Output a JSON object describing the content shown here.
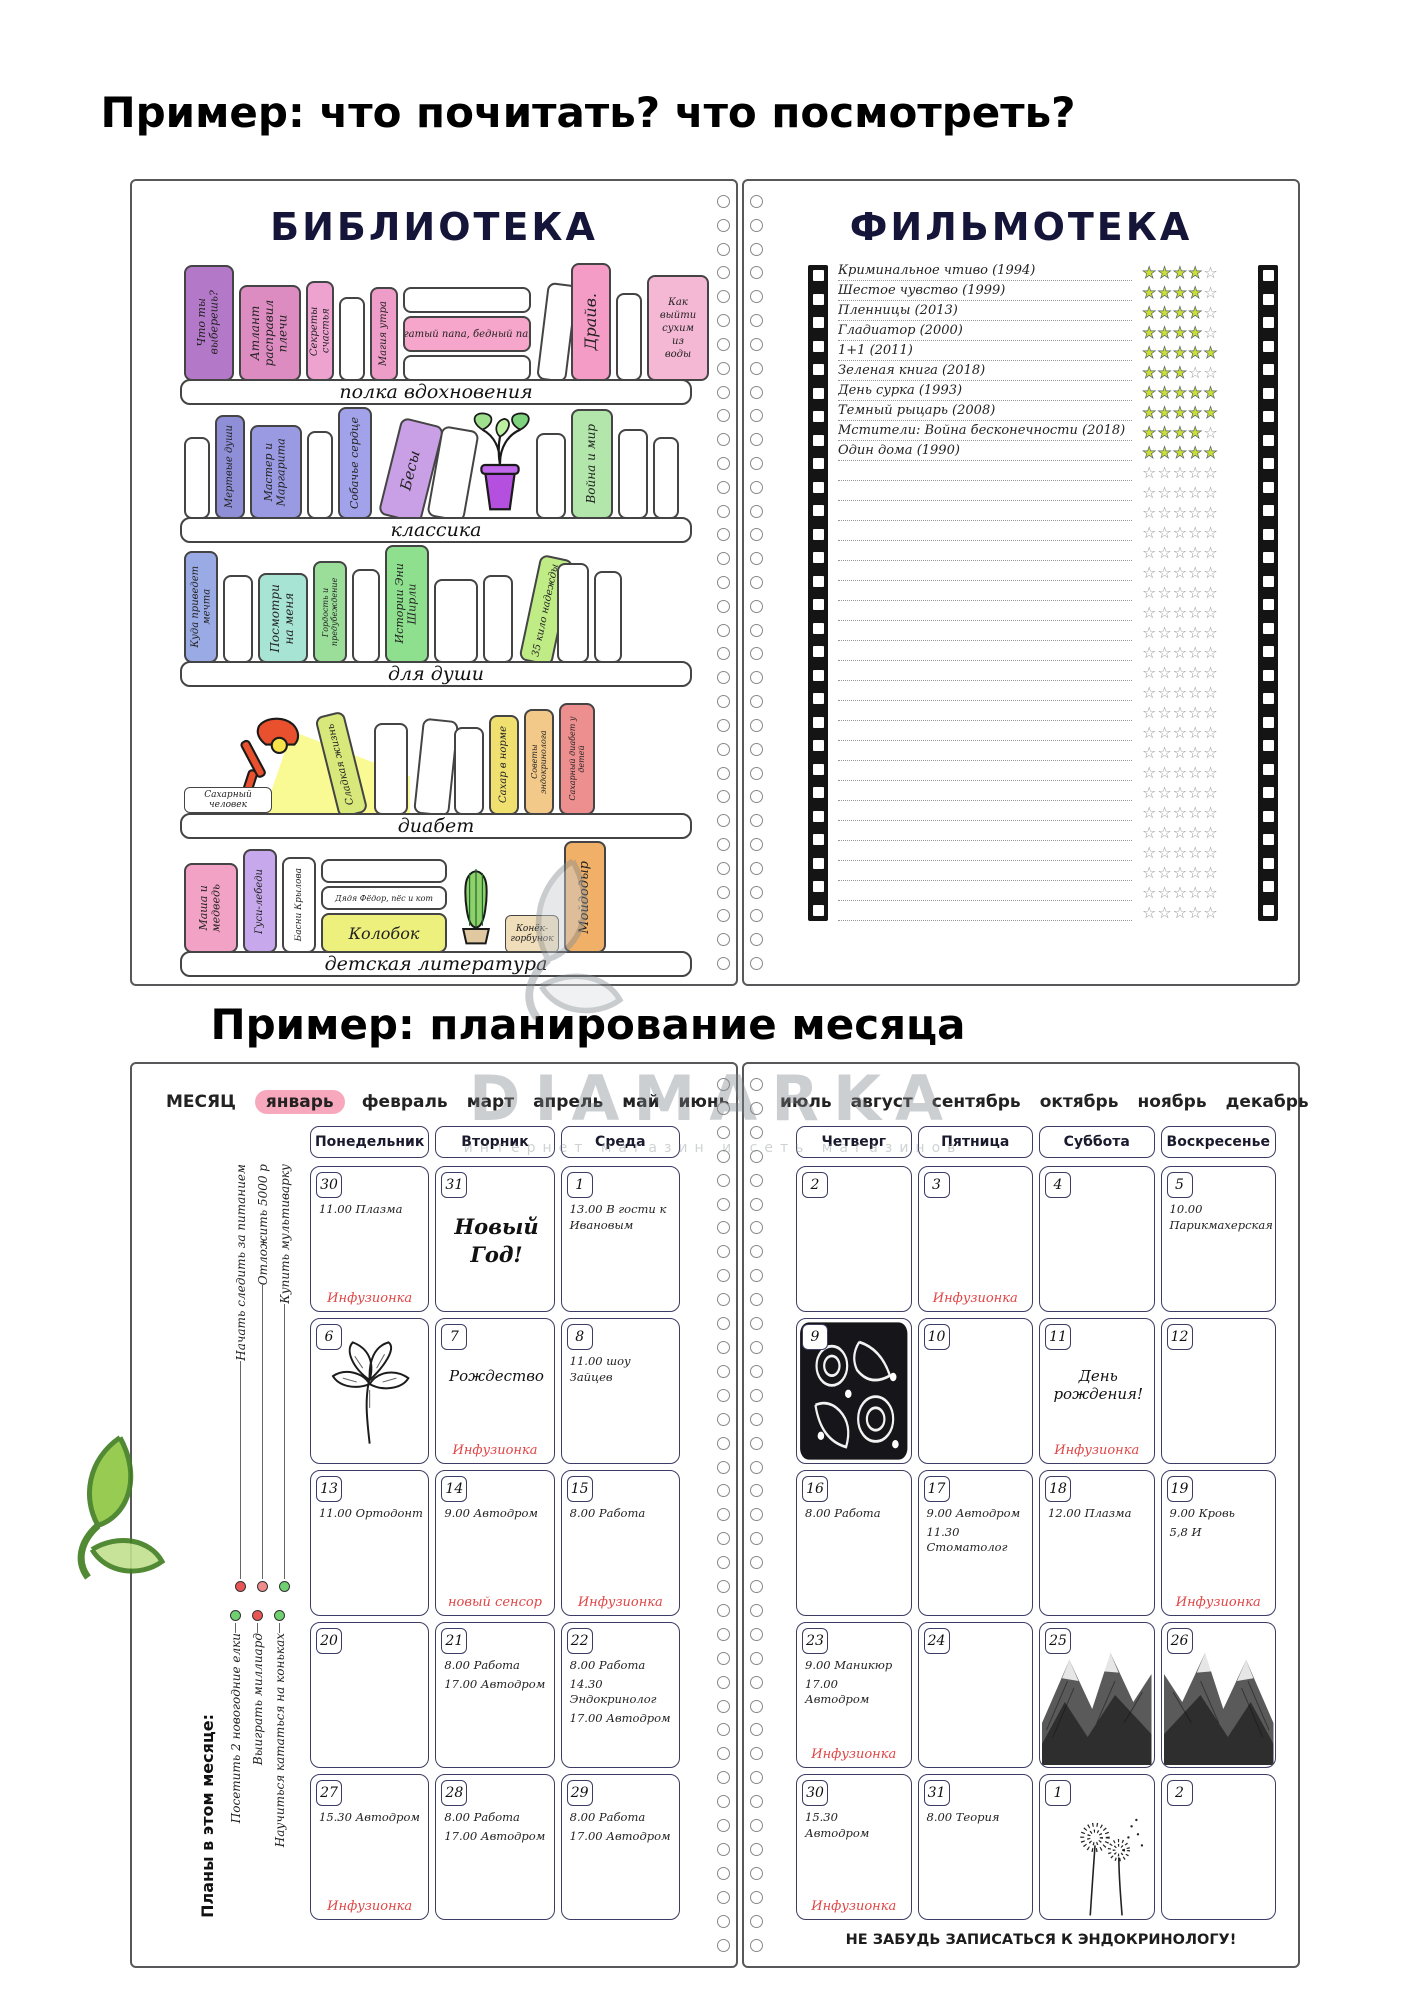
{
  "page": {
    "title_reading": "Пример: что почитать? что посмотреть?",
    "title_planning": "Пример: планирование месяца"
  },
  "watermark": {
    "brand": "DIAMARKA",
    "subtitle": "интернет магазин и сеть магазинов"
  },
  "colors": {
    "accent_red": "#e04545",
    "star_fill": "#ccdf35",
    "star_empty": "#999999",
    "month_highlight": "#f8a8bc"
  },
  "library": {
    "title": "БИБЛИОТЕКА",
    "shelves": [
      {
        "label": "полка вдохновения",
        "books": [
          {
            "k": "v",
            "t": "Что ты выберешь?",
            "c": "#b478c8",
            "w": 50,
            "h": 116,
            "fs": 11
          },
          {
            "k": "v",
            "t": "Атлант расправил плечи",
            "c": "#dc8cc0",
            "w": 62,
            "h": 96,
            "fs": 12
          },
          {
            "k": "v",
            "t": "Секреты счастья",
            "c": "#eea2d0",
            "w": 28,
            "h": 100,
            "fs": 10
          },
          {
            "k": "v",
            "t": "",
            "c": "#ffffff",
            "w": 26,
            "h": 84
          },
          {
            "k": "v",
            "t": "Магия утра",
            "c": "#ee9cc8",
            "w": 28,
            "h": 94,
            "fs": 10
          },
          {
            "k": "stack",
            "w": 128,
            "items": [
              {
                "t": "",
                "h": 26
              },
              {
                "t": "Богатый папа, бедный папа.",
                "c": "#f6a6ca",
                "h": 36,
                "fs": 10
              },
              {
                "t": "",
                "h": 26
              }
            ]
          },
          {
            "k": "v",
            "t": "",
            "c": "#ffffff",
            "w": 30,
            "h": 98,
            "r": 7
          },
          {
            "k": "v",
            "t": "Драйв.",
            "c": "#f49cc6",
            "w": 40,
            "h": 118,
            "fs": 16
          },
          {
            "k": "v",
            "t": "",
            "c": "#ffffff",
            "w": 26,
            "h": 88
          },
          {
            "k": "vh",
            "t": "Как выйти сухим из воды",
            "c": "#f5b8d4",
            "w": 62,
            "h": 106,
            "fs": 10
          }
        ]
      },
      {
        "label": "классика",
        "books": [
          {
            "k": "v",
            "t": "",
            "c": "#ffffff",
            "w": 26,
            "h": 82
          },
          {
            "k": "v",
            "t": "Мертвые души",
            "c": "#8f8fd8",
            "w": 30,
            "h": 104,
            "fs": 10
          },
          {
            "k": "v",
            "t": "Мастер и Маргарита",
            "c": "#9a9ae2",
            "w": 52,
            "h": 94,
            "fs": 11
          },
          {
            "k": "v",
            "t": "",
            "c": "#ffffff",
            "w": 26,
            "h": 88
          },
          {
            "k": "v",
            "t": "Собачье сердце",
            "c": "#a2a2ea",
            "w": 34,
            "h": 112,
            "fs": 11
          },
          {
            "k": "v",
            "t": "Бесы",
            "c": "#c9a0e6",
            "w": 44,
            "h": 100,
            "r": 14,
            "fs": 15
          },
          {
            "k": "v",
            "t": "",
            "c": "#ffffff",
            "w": 38,
            "h": 92,
            "r": 10
          },
          {
            "k": "plant"
          },
          {
            "k": "v",
            "t": "",
            "c": "#ffffff",
            "w": 30,
            "h": 86
          },
          {
            "k": "v",
            "t": "Война и мир",
            "c": "#b2e6aa",
            "w": 42,
            "h": 110,
            "fs": 12
          },
          {
            "k": "v",
            "t": "",
            "c": "#ffffff",
            "w": 30,
            "h": 90
          },
          {
            "k": "v",
            "t": "",
            "c": "#ffffff",
            "w": 26,
            "h": 82
          }
        ]
      },
      {
        "label": "для души",
        "books": [
          {
            "k": "v",
            "t": "Куда приведет мечта",
            "c": "#9aaae4",
            "w": 34,
            "h": 112,
            "fs": 10
          },
          {
            "k": "v",
            "t": "",
            "c": "#ffffff",
            "w": 30,
            "h": 88
          },
          {
            "k": "v",
            "t": "Посмотри на меня",
            "c": "#a8e4d4",
            "w": 50,
            "h": 90,
            "fs": 12
          },
          {
            "k": "v",
            "t": "Гордость и предубеждение",
            "c": "#9ade9a",
            "w": 34,
            "h": 102,
            "fs": 8
          },
          {
            "k": "v",
            "t": "",
            "c": "#ffffff",
            "w": 28,
            "h": 94
          },
          {
            "k": "v",
            "t": "Истории Эни Ширли",
            "c": "#8ee08e",
            "w": 44,
            "h": 118,
            "fs": 11
          },
          {
            "k": "v",
            "t": "",
            "c": "#ffffff",
            "w": 44,
            "h": 84
          },
          {
            "k": "v",
            "t": "",
            "c": "#ffffff",
            "w": 30,
            "h": 88
          },
          {
            "k": "v",
            "t": "35 кило надежды",
            "c": "#c0ec86",
            "w": 34,
            "h": 108,
            "r": 12,
            "fs": 10
          },
          {
            "k": "v",
            "t": "",
            "c": "#ffffff",
            "w": 32,
            "h": 100
          },
          {
            "k": "v",
            "t": "",
            "c": "#ffffff",
            "w": 28,
            "h": 92
          }
        ]
      },
      {
        "label": "диабет",
        "books": [
          {
            "k": "lamp",
            "label": "Сахарный человек"
          },
          {
            "k": "v",
            "t": "Сладкая жизнь",
            "c": "#d8e87a",
            "w": 30,
            "h": 104,
            "r": -14,
            "fs": 10
          },
          {
            "k": "v",
            "t": "",
            "c": "#ffffff",
            "w": 34,
            "h": 92
          },
          {
            "k": "v",
            "t": "",
            "c": "#ffffff",
            "w": 36,
            "h": 96,
            "r": 6
          },
          {
            "k": "v",
            "t": "",
            "c": "#ffffff",
            "w": 30,
            "h": 88
          },
          {
            "k": "v",
            "t": "Сахар в норме",
            "c": "#f0e070",
            "w": 30,
            "h": 100,
            "fs": 10
          },
          {
            "k": "v",
            "t": "Советы эндокринолога",
            "c": "#f3c98a",
            "w": 30,
            "h": 106,
            "fs": 8
          },
          {
            "k": "v",
            "t": "Сахарный диабет у детей",
            "c": "#ee8f8f",
            "w": 36,
            "h": 112,
            "fs": 8
          }
        ]
      },
      {
        "label": "детская литература",
        "books": [
          {
            "k": "v",
            "t": "Маша и медведь",
            "c": "#f2a2c4",
            "w": 54,
            "h": 90,
            "fs": 11
          },
          {
            "k": "v",
            "t": "Гуси-лебеди",
            "c": "#c8a8ec",
            "w": 34,
            "h": 104,
            "fs": 10
          },
          {
            "k": "v",
            "t": "Басни Крылова",
            "c": "#ffffff",
            "w": 34,
            "h": 96,
            "fs": 9
          },
          {
            "k": "stack",
            "w": 126,
            "items": [
              {
                "t": "",
                "h": 24
              },
              {
                "t": "Дядя Фёдор, пёс и кот",
                "c": "#ffffff",
                "h": 24,
                "fs": 8
              },
              {
                "t": "Колобок",
                "c": "#eef07e",
                "h": 40,
                "fs": 16
              }
            ]
          },
          {
            "k": "cactus"
          },
          {
            "k": "box",
            "t": "Конёк-горбунок",
            "c": "#f0ddba",
            "w": 54,
            "h": 38,
            "fs": 9
          },
          {
            "k": "v",
            "t": "Мойдодыр",
            "c": "#f0b068",
            "w": 42,
            "h": 112,
            "fs": 13
          }
        ]
      }
    ]
  },
  "filmoteka": {
    "title": "ФИЛЬМОТЕКА",
    "stars_per_row": 5,
    "empty_rows": 23,
    "films": [
      {
        "title": "Криминальное чтиво (1994)",
        "rating": 4
      },
      {
        "title": "Шестое чувство (1999)",
        "rating": 4
      },
      {
        "title": "Пленницы (2013)",
        "rating": 4
      },
      {
        "title": "Гладиатор (2000)",
        "rating": 4
      },
      {
        "title": "1+1 (2011)",
        "rating": 5
      },
      {
        "title": "Зеленая книга (2018)",
        "rating": 3
      },
      {
        "title": "День сурка (1993)",
        "rating": 5
      },
      {
        "title": "Темный рыцарь (2008)",
        "rating": 5
      },
      {
        "title": "Мстители: Война бесконечности (2018)",
        "rating": 4
      },
      {
        "title": "Один дома (1990)",
        "rating": 5
      }
    ]
  },
  "calendar": {
    "month_label": "МЕСЯЦ",
    "months_left": [
      "январь",
      "февраль",
      "март",
      "апрель",
      "май",
      "июнь"
    ],
    "months_right": [
      "июль",
      "август",
      "сентябрь",
      "октябрь",
      "ноябрь",
      "декабрь"
    ],
    "selected_month": "январь",
    "left_days": [
      "Понедельник",
      "Вторник",
      "Среда"
    ],
    "right_days": [
      "Четверг",
      "Пятница",
      "Суббота",
      "Воскресенье"
    ],
    "sidebar": {
      "goals_top": [
        {
          "t": "Начать следить за питанием",
          "dot": "#e85555"
        },
        {
          "t": "Отложить 5000 р",
          "dot": "#ef8b8b"
        },
        {
          "t": "Купить мультиварку",
          "dot": "#6fd06f"
        }
      ],
      "plans_title": "Планы в этом месяце:",
      "plans": [
        {
          "t": "Посетить 2 новогодние елки",
          "dot": "#6fd06f"
        },
        {
          "t": "Выиграть миллиард",
          "dot": "#e85555"
        },
        {
          "t": "Научиться кататься на коньках",
          "dot": "#6fd06f"
        }
      ]
    },
    "left_cells": [
      {
        "d": "30",
        "lines": [
          "11.00 Плазма"
        ],
        "red": "Инфузионка"
      },
      {
        "d": "31",
        "big": "Новый Год!"
      },
      {
        "d": "1",
        "lines": [
          "13.00 В гости к Ивановым"
        ]
      },
      {
        "d": "6",
        "img": "flower"
      },
      {
        "d": "7",
        "mid": "Рождество",
        "red": "Инфузионка"
      },
      {
        "d": "8",
        "lines": [
          "11.00 шоу Зайцев"
        ]
      },
      {
        "d": "13",
        "lines": [
          "11.00 Ортодонт"
        ]
      },
      {
        "d": "14",
        "lines": [
          "9.00 Автодром"
        ],
        "red": "новый сенсор"
      },
      {
        "d": "15",
        "lines": [
          "8.00 Работа"
        ],
        "red": "Инфузионка"
      },
      {
        "d": "20"
      },
      {
        "d": "21",
        "lines": [
          "8.00 Работа",
          "17.00 Автодром"
        ]
      },
      {
        "d": "22",
        "lines": [
          "8.00 Работа",
          "14.30 Эндокринолог",
          "17.00 Автодром"
        ]
      },
      {
        "d": "27",
        "lines": [
          "15.30 Автодром"
        ],
        "red": "Инфузионка"
      },
      {
        "d": "28",
        "lines": [
          "8.00 Работа",
          "17.00 Автодром"
        ]
      },
      {
        "d": "29",
        "lines": [
          "8.00 Работа",
          "17.00 Автодром"
        ]
      }
    ],
    "right_cells": [
      {
        "d": "2"
      },
      {
        "d": "3",
        "red": "Инфузионка"
      },
      {
        "d": "4"
      },
      {
        "d": "5",
        "lines": [
          "10.00 Парикмахерская"
        ]
      },
      {
        "d": "9",
        "img": "ornament"
      },
      {
        "d": "10"
      },
      {
        "d": "11",
        "mid": "День рождения!",
        "red": "Инфузионка"
      },
      {
        "d": "12"
      },
      {
        "d": "16",
        "lines": [
          "8.00 Работа"
        ]
      },
      {
        "d": "17",
        "lines": [
          "9.00 Автодром",
          "11.30 Стоматолог"
        ]
      },
      {
        "d": "18",
        "lines": [
          "12.00 Плазма"
        ]
      },
      {
        "d": "19",
        "lines": [
          "9.00 Кровь",
          "5,8 И"
        ],
        "red": "Инфузионка"
      },
      {
        "d": "23",
        "lines": [
          "9.00 Маникюр",
          "17.00 Автодром"
        ],
        "red": "Инфузионка"
      },
      {
        "d": "24"
      },
      {
        "d": "25",
        "img": "mountain"
      },
      {
        "d": "26",
        "img": "mountain2"
      },
      {
        "d": "30",
        "lines": [
          "15.30 Автодром"
        ],
        "red": "Инфузионка"
      },
      {
        "d": "31",
        "lines": [
          "8.00 Теория"
        ]
      },
      {
        "d": "1",
        "img": "dandelion"
      },
      {
        "d": "2"
      }
    ],
    "footer_note": "НЕ ЗАБУДЬ ЗАПИСАТЬСЯ К ЭНДОКРИНОЛОГУ!"
  }
}
